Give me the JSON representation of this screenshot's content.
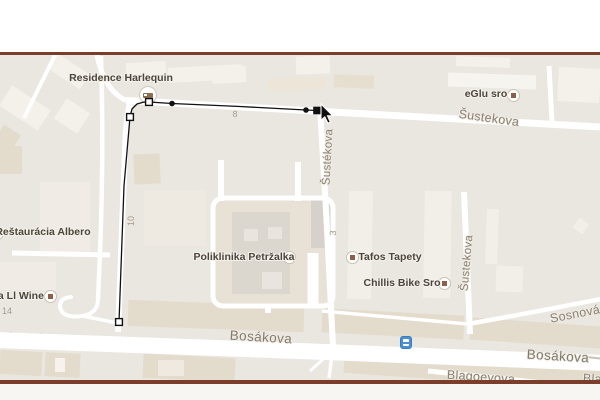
{
  "colors": {
    "border_line": "#7b3e2b",
    "map_background": "#eae6e0",
    "road": "#ffffff",
    "building_light": "#f4f1eb",
    "building_tan": "#e3dbcb",
    "route_stroke": "#111111",
    "poi_marker_dot": "#8d5f49",
    "transit_blue": "#4b90d5",
    "poi_text": "#4d463c",
    "street_text": "#8b8173"
  },
  "map": {
    "poi_labels": {
      "residence_harlequin": "Residence Harlequin",
      "eglu_sro": "eGlu sro",
      "restauracia_albero": "Reštaurácia Albero",
      "ka_ll_wine": "ka Ll Wine",
      "poliklinika_petrzalka": "Poliklinika Petržalka",
      "tafos_tapety": "Tafos Tapety",
      "chillis_bike_sro": "Chillis Bike Sro"
    },
    "street_labels": {
      "sustekova_top": "Šustekova",
      "sustekova_mid": "Šustékova",
      "sustekova_right": "Šustekova",
      "sosnova": "Sosnová",
      "bosakova_left": "Bosákova",
      "bosakova_right": "Bosákova",
      "blagoevova": "Blagoevova",
      "blagoevova_partial": "Blag"
    },
    "house_numbers": {
      "n8": "8",
      "n10": "10",
      "n3": "3",
      "n14": "14"
    },
    "icons": {
      "lodging": "bed-icon",
      "transit": "bus-icon",
      "poi_marker": "dot-marker-icon",
      "cursor": "arrow-cursor"
    }
  },
  "route": {
    "stroke": "#111111",
    "path_points": [
      [
        119,
        322
      ],
      [
        124,
        186
      ],
      [
        130,
        117
      ],
      [
        132,
        109
      ],
      [
        137,
        104
      ],
      [
        144,
        102
      ],
      [
        149,
        102
      ],
      [
        172,
        103.5
      ],
      [
        240,
        106.5
      ],
      [
        306,
        110
      ],
      [
        317,
        110.5
      ]
    ],
    "open_square_vertices": [
      [
        119,
        322
      ],
      [
        130,
        117
      ],
      [
        149,
        102
      ]
    ],
    "dot_vertices": [
      [
        172,
        103.5
      ],
      [
        306,
        110
      ]
    ],
    "selected_vertex": [
      317,
      110.5
    ],
    "cursor_tip": [
      321,
      104
    ]
  }
}
